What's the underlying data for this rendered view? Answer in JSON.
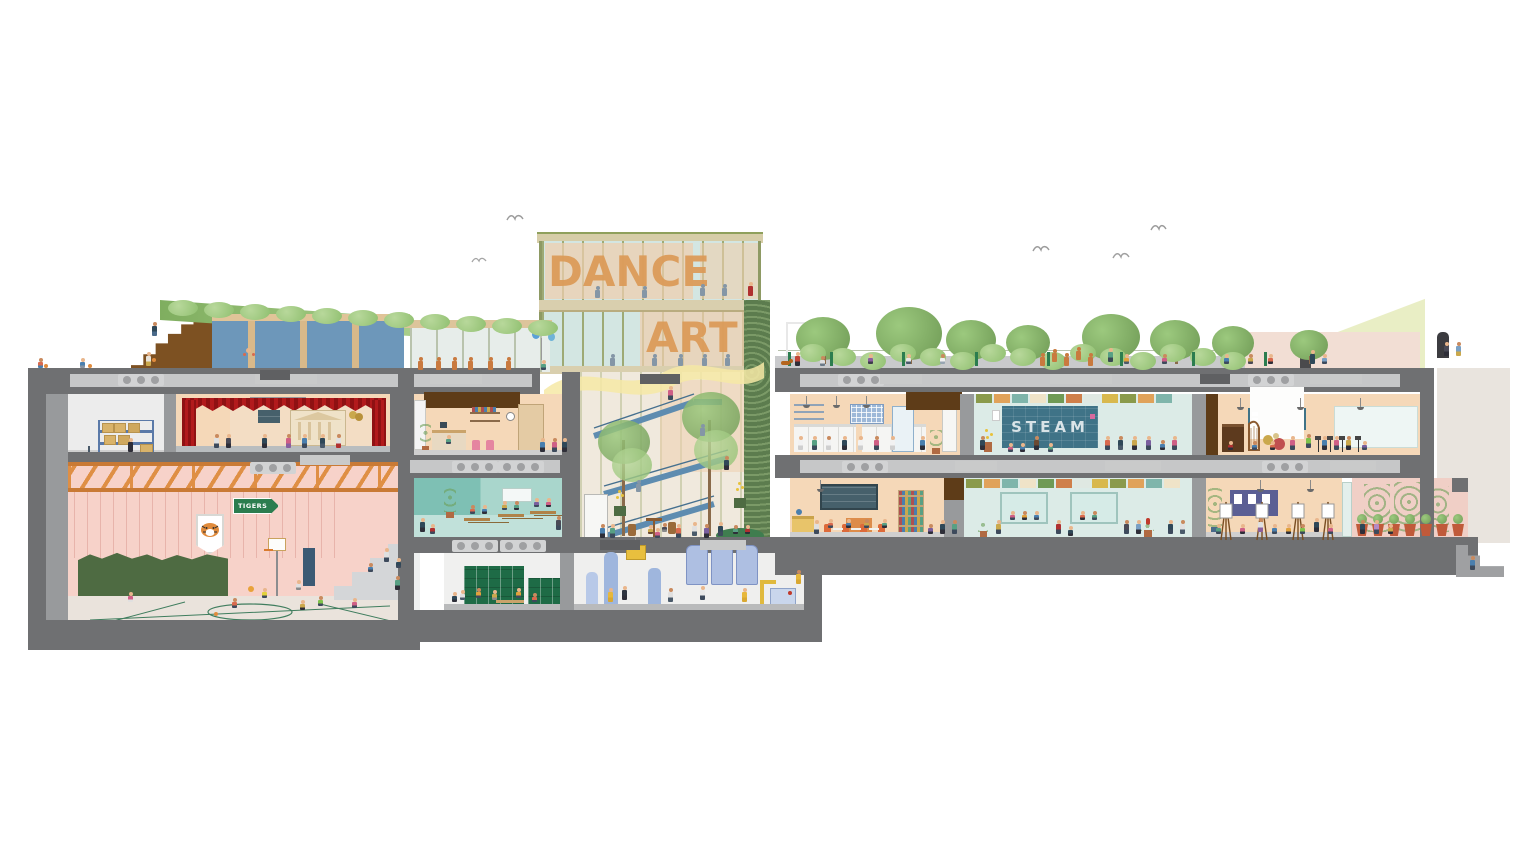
{
  "illustration": {
    "type": "architectural-section-of-school-building",
    "signage": {
      "tower_top": "DANCE",
      "tower_mid": "ART",
      "gym_pennant": "TIGERS",
      "mural": "STEAM"
    },
    "palette": {
      "structure": "#6f7072",
      "structureLight": "#989a9c",
      "slabInner": "#c6c7c8",
      "wallPeach": "#f5d8b8",
      "gymPink": "#f7d2c9",
      "curtainRed": "#a8191b",
      "trussOrange": "#df8f45",
      "tealWall": "#7ec0b4",
      "tealFloor": "#c1e1da",
      "corridorBlue": "#dcebe7",
      "chalkTeal": "#3f7387",
      "glass": "#d3e6e2",
      "mullion": "#9aa86a",
      "letterOrange": "#dc9a57",
      "stairBlue": "#5e8cb0",
      "canopyYellow": "#f6e9a6",
      "roofGreen": "#8fbf6f",
      "darkGreenWall": "#5c7c4e",
      "bleacherBrown": "#7d5122",
      "beamBrown": "#5e3c18",
      "poolBlue": "#6d97ba",
      "lockerGreen": "#1e6b46",
      "floorGray": "#b9bab8",
      "backdropBeige": "#e9e4de",
      "pinkDeck": "#f2ded4",
      "climbGreen": "#4e6b42",
      "signGreen": "#2c7d4f",
      "silOrange": "#c97a3f",
      "silGray": "#8496a6"
    },
    "tile_colors": [
      "#8a9a4b",
      "#e0a25a",
      "#7fb5ab",
      "#efe3c8",
      "#6f9a55",
      "#cf7f4a",
      "#dfe8e2",
      "#d8b84e"
    ]
  }
}
